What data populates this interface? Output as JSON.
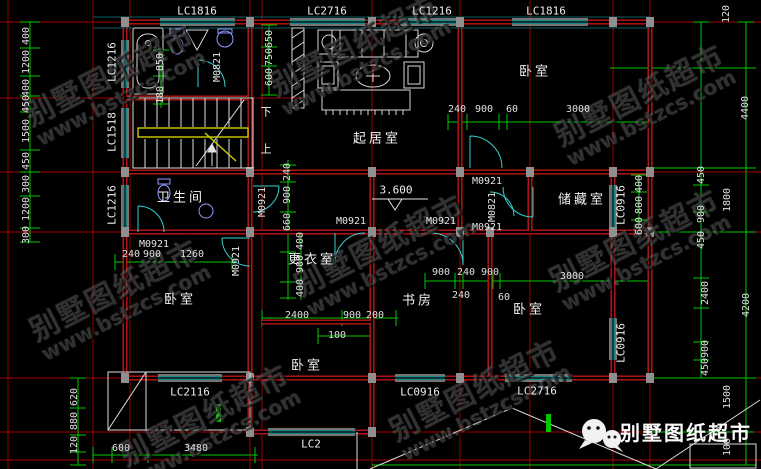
{
  "watermark": {
    "brand": "别墅图纸超市",
    "url": "www.bstzcs.com"
  },
  "footer": {
    "brand": "别墅图纸超市"
  },
  "rooms": {
    "living": "起居室",
    "bedroom_top_right": "卧室",
    "bathroom": "卫生间",
    "storage": "储藏室",
    "dressing": "更衣室",
    "study": "书房",
    "bedroom_left": "卧室",
    "bedroom_right": "卧室",
    "bedroom_bottom": "卧室"
  },
  "stairs": {
    "down": "下",
    "up": "上"
  },
  "elevation": {
    "value": "3.600"
  },
  "windows": {
    "top": [
      "LC1816",
      "LC2716",
      "LC1216",
      "LC1816"
    ],
    "left": [
      "LC1216",
      "LC1518",
      "LC1216"
    ],
    "mid": [
      "LC0916",
      "LC0916"
    ],
    "bottom": [
      "LC2116",
      "LC0916",
      "LC2716",
      "LC2"
    ]
  },
  "doors": {
    "bath": "M0821",
    "hall": "M0921",
    "row1": "M0921",
    "row2": "M0921",
    "row3": "M0921",
    "storage_top": "M0921",
    "storage_side": "M0821",
    "bedroom_left": "M0921",
    "bedroom_left_side": "M0921"
  },
  "dims": {
    "left": [
      "400",
      "1200",
      "400",
      "450",
      "1500",
      "450",
      "300",
      "1200",
      "300"
    ],
    "bath": [
      "850",
      "180"
    ],
    "living_left": [
      "650",
      "750",
      "600"
    ],
    "top_chain": [
      "240",
      "900",
      "60",
      "3000"
    ],
    "hall_v": [
      "240",
      "900",
      "660"
    ],
    "dressing_v": [
      "400",
      "900",
      "400"
    ],
    "bedroom_left_chain": [
      "240",
      "900",
      "1260"
    ],
    "bottom_mid": [
      "2400",
      "900",
      "200",
      "100"
    ],
    "study_chain": [
      "900",
      "240",
      "900",
      "240",
      "60",
      "3000"
    ],
    "storage_v": [
      "400",
      "800",
      "600"
    ],
    "right_inner": [
      "450",
      "900",
      "450",
      "2400",
      "900",
      "450"
    ],
    "right_outer": [
      "120",
      "4400",
      "1800",
      "4200",
      "1500",
      "100"
    ],
    "bottom_left_v": [
      "620",
      "880",
      "120"
    ],
    "bottom_left_h": [
      "600",
      "3480"
    ]
  }
}
